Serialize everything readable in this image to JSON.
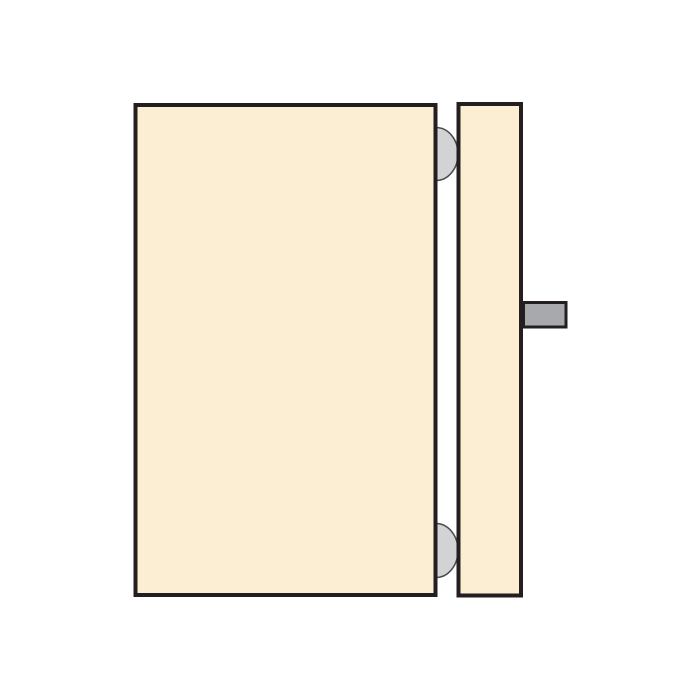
{
  "diagram": {
    "kind": "technical-illustration",
    "subject": "door panel and frame jamb with hinges and latch handle",
    "colors": {
      "background": "#ffffff",
      "panel_fill": "#fceed3",
      "outline": "#231f20",
      "hinge_fill": "#d1d3d4",
      "hinge_stroke": "#4a4a4c",
      "handle_fill": "#a7a9ac",
      "handle_stroke": "#231f20"
    },
    "components": [
      {
        "name": "door-panel",
        "shape": "large bordered rectangle, left side"
      },
      {
        "name": "door-jamb",
        "shape": "narrow bordered rectangle, right side"
      },
      {
        "name": "hinge-top",
        "shape": "gray half-disc in gap, upper"
      },
      {
        "name": "hinge-bottom",
        "shape": "gray half-disc in gap, lower"
      },
      {
        "name": "latch-handle",
        "shape": "small gray rectangle protruding right of jamb"
      }
    ]
  }
}
